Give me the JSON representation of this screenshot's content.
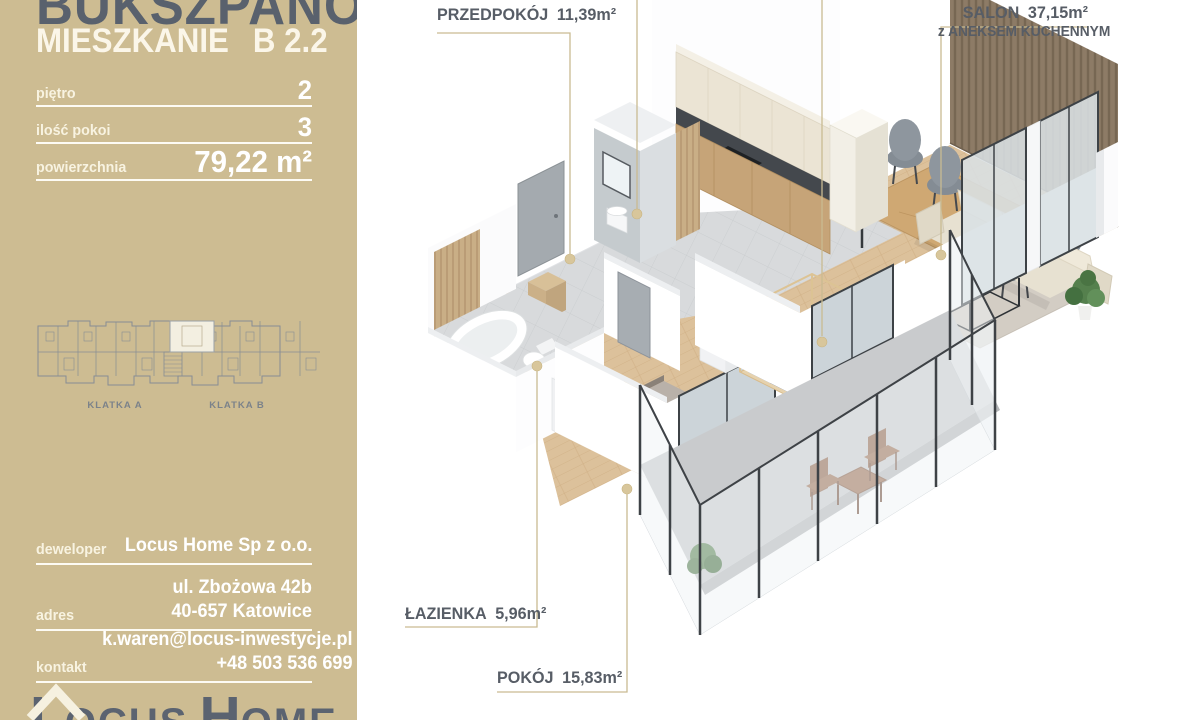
{
  "sidebar": {
    "project_title": "BUKSZPANOWA",
    "apartment_word": "MIESZKANIE",
    "apartment_code": "B 2.2",
    "specs": [
      {
        "label": "piętro",
        "value": "2"
      },
      {
        "label": "ilość pokoi",
        "value": "3"
      },
      {
        "label": "powierzchnia",
        "value": "79,22 m²"
      }
    ],
    "building_labels": {
      "klatka_a": "KLATKA A",
      "klatka_b": "KLATKA B"
    },
    "info_rows": [
      {
        "label": "deweloper",
        "line1": "Locus Home Sp z o.o.",
        "line2": ""
      },
      {
        "label": "adres",
        "line1": "ul. Zbożowa 42b",
        "line2": "40-657 Katowice"
      },
      {
        "label": "kontakt",
        "line1": "k.waren@locus-inwestycje.pl",
        "line2": "+48 503 536 699"
      }
    ],
    "logo": {
      "part1": "L",
      "part2": "OCUS",
      "part3": "H",
      "part4": "OME"
    }
  },
  "floorplan": {
    "room_labels": [
      {
        "id": "przedpokoj",
        "name": "PRZEDPOKÓJ",
        "area": "11,39m²"
      },
      {
        "id": "salon",
        "name": "SALON",
        "area": "37,15m²",
        "subtitle": "z ANEKSEM KUCHENNYM"
      },
      {
        "id": "lazienka",
        "name": "ŁAZIENKA",
        "area": "5,96m²"
      },
      {
        "id": "pokoj",
        "name": "POKÓJ",
        "area": "15,83m²"
      }
    ]
  },
  "colors": {
    "sidebar_bg": "#cdbc92",
    "title_dark": "#59616d",
    "text_light": "#fbf6e9",
    "label_gray": "#575d66",
    "leader_line": "#c9bb92",
    "wood_floor": "#dcc19b",
    "tile_floor": "#d8dadc",
    "balcony_floor": "#c9cbcd",
    "accent_tan": "#c9ae86"
  }
}
